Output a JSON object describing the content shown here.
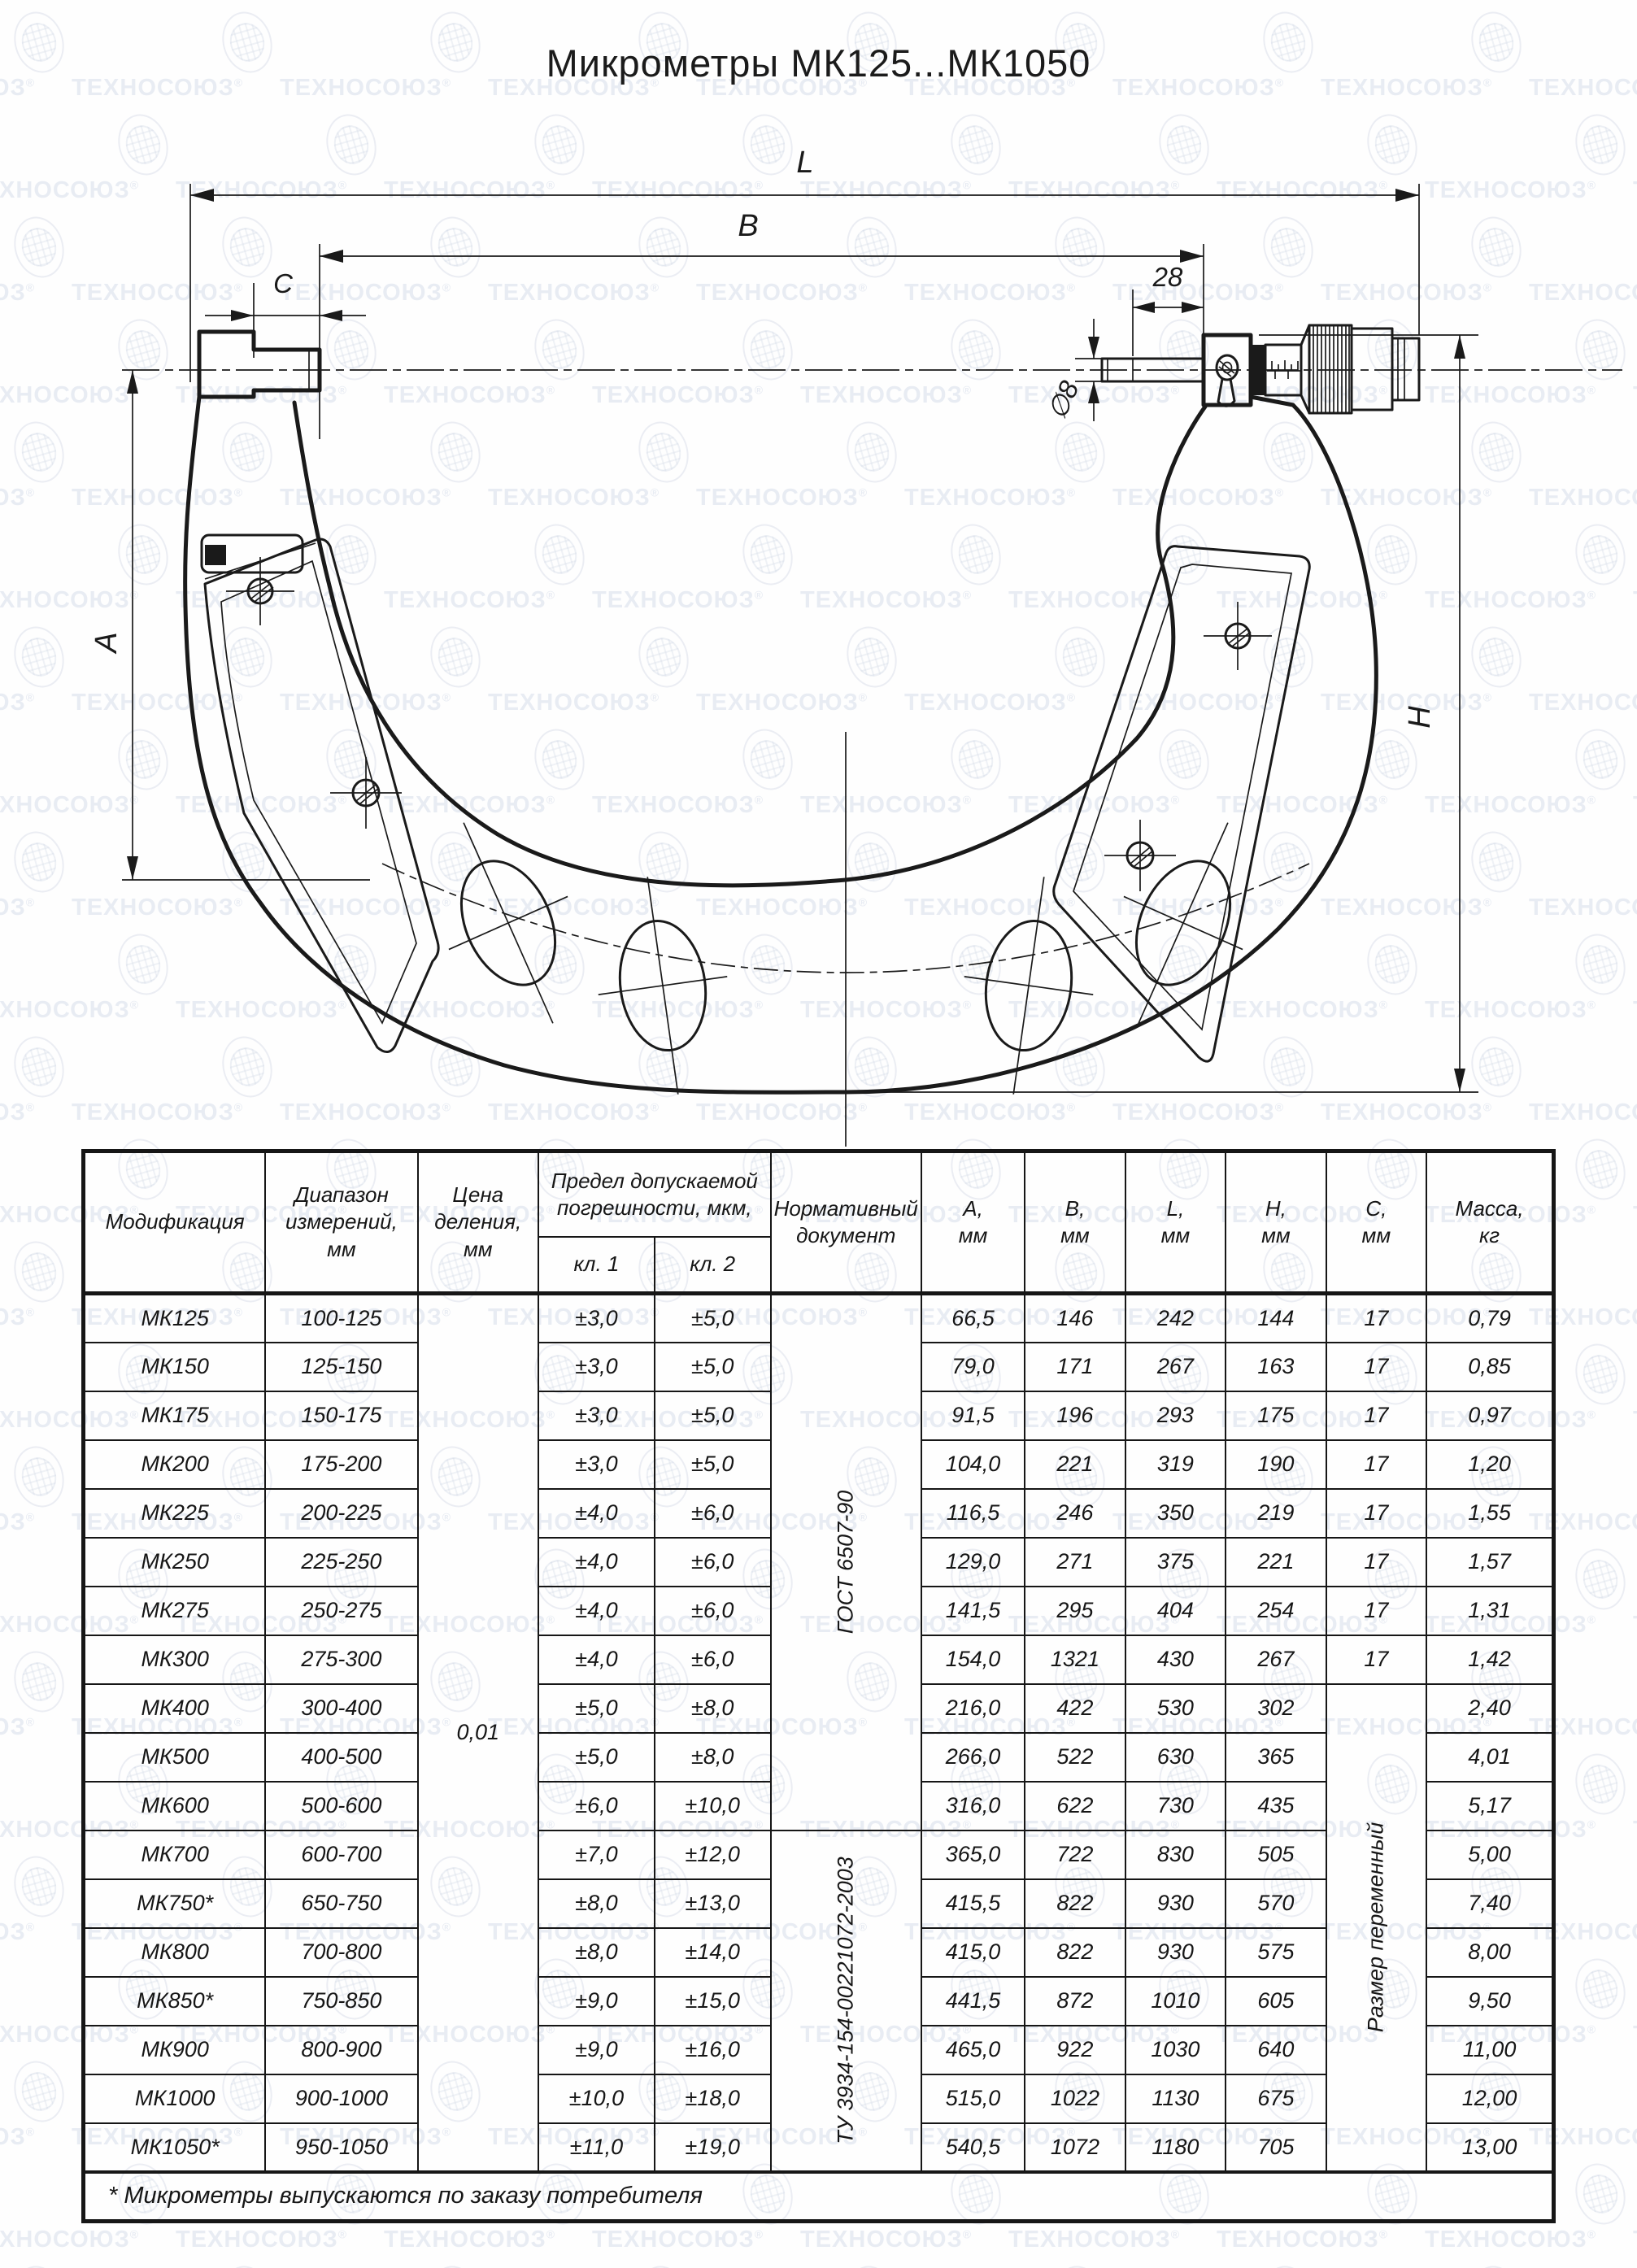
{
  "title": "Микрометры МК125...МК1050",
  "watermark": {
    "text": "ТЕХНОСОЮЗ",
    "reg": "®",
    "color": "#dbe1ec"
  },
  "drawing": {
    "dims": {
      "L": "L",
      "B": "B",
      "C": "C",
      "d28": "28",
      "dia8": "∅8",
      "A": "A",
      "H": "H"
    }
  },
  "table": {
    "headers": {
      "mod": [
        "Модификация"
      ],
      "range": [
        "Диапазон",
        "измерений,",
        "мм"
      ],
      "price": [
        "Цена",
        "деления,",
        "мм"
      ],
      "limit": [
        "Предел допускаемой",
        "погрешности, мкм,"
      ],
      "kl1": "кл. 1",
      "kl2": "кл. 2",
      "doc": [
        "Нормативный",
        "документ"
      ],
      "a": [
        "А,",
        "мм"
      ],
      "b": [
        "В,",
        "мм"
      ],
      "l": [
        "L,",
        "мм"
      ],
      "h": [
        "Н,",
        "мм"
      ],
      "c": [
        "С,",
        "мм"
      ],
      "mass": [
        "Масса,",
        "кг"
      ]
    },
    "merged": {
      "price": "0,01",
      "doc1": "ГОСТ 6507-90",
      "doc1_rows": 11,
      "doc2": "ТУ 3934-154-00221072-2003",
      "doc2_rows": 7,
      "c_var": "Размер переменный",
      "c_var_rows": 10
    },
    "rows": [
      {
        "mod": "МК125",
        "range": "100-125",
        "kl1": "±3,0",
        "kl2": "±5,0",
        "a": "66,5",
        "b": "146",
        "l": "242",
        "h": "144",
        "c": "17",
        "m": "0,79"
      },
      {
        "mod": "МК150",
        "range": "125-150",
        "kl1": "±3,0",
        "kl2": "±5,0",
        "a": "79,0",
        "b": "171",
        "l": "267",
        "h": "163",
        "c": "17",
        "m": "0,85"
      },
      {
        "mod": "МК175",
        "range": "150-175",
        "kl1": "±3,0",
        "kl2": "±5,0",
        "a": "91,5",
        "b": "196",
        "l": "293",
        "h": "175",
        "c": "17",
        "m": "0,97"
      },
      {
        "mod": "МК200",
        "range": "175-200",
        "kl1": "±3,0",
        "kl2": "±5,0",
        "a": "104,0",
        "b": "221",
        "l": "319",
        "h": "190",
        "c": "17",
        "m": "1,20"
      },
      {
        "mod": "МК225",
        "range": "200-225",
        "kl1": "±4,0",
        "kl2": "±6,0",
        "a": "116,5",
        "b": "246",
        "l": "350",
        "h": "219",
        "c": "17",
        "m": "1,55"
      },
      {
        "mod": "МК250",
        "range": "225-250",
        "kl1": "±4,0",
        "kl2": "±6,0",
        "a": "129,0",
        "b": "271",
        "l": "375",
        "h": "221",
        "c": "17",
        "m": "1,57"
      },
      {
        "mod": "МК275",
        "range": "250-275",
        "kl1": "±4,0",
        "kl2": "±6,0",
        "a": "141,5",
        "b": "295",
        "l": "404",
        "h": "254",
        "c": "17",
        "m": "1,31"
      },
      {
        "mod": "МК300",
        "range": "275-300",
        "kl1": "±4,0",
        "kl2": "±6,0",
        "a": "154,0",
        "b": "1321",
        "l": "430",
        "h": "267",
        "c": "17",
        "m": "1,42"
      },
      {
        "mod": "МК400",
        "range": "300-400",
        "kl1": "±5,0",
        "kl2": "±8,0",
        "a": "216,0",
        "b": "422",
        "l": "530",
        "h": "302",
        "m": "2,40"
      },
      {
        "mod": "МК500",
        "range": "400-500",
        "kl1": "±5,0",
        "kl2": "±8,0",
        "a": "266,0",
        "b": "522",
        "l": "630",
        "h": "365",
        "m": "4,01"
      },
      {
        "mod": "МК600",
        "range": "500-600",
        "kl1": "±6,0",
        "kl2": "±10,0",
        "a": "316,0",
        "b": "622",
        "l": "730",
        "h": "435",
        "m": "5,17"
      },
      {
        "mod": "МК700",
        "range": "600-700",
        "kl1": "±7,0",
        "kl2": "±12,0",
        "a": "365,0",
        "b": "722",
        "l": "830",
        "h": "505",
        "m": "5,00"
      },
      {
        "mod": "МК750*",
        "range": "650-750",
        "kl1": "±8,0",
        "kl2": "±13,0",
        "a": "415,5",
        "b": "822",
        "l": "930",
        "h": "570",
        "m": "7,40"
      },
      {
        "mod": "МК800",
        "range": "700-800",
        "kl1": "±8,0",
        "kl2": "±14,0",
        "a": "415,0",
        "b": "822",
        "l": "930",
        "h": "575",
        "m": "8,00"
      },
      {
        "mod": "МК850*",
        "range": "750-850",
        "kl1": "±9,0",
        "kl2": "±15,0",
        "a": "441,5",
        "b": "872",
        "l": "1010",
        "h": "605",
        "m": "9,50"
      },
      {
        "mod": "МК900",
        "range": "800-900",
        "kl1": "±9,0",
        "kl2": "±16,0",
        "a": "465,0",
        "b": "922",
        "l": "1030",
        "h": "640",
        "m": "11,00"
      },
      {
        "mod": "МК1000",
        "range": "900-1000",
        "kl1": "±10,0",
        "kl2": "±18,0",
        "a": "515,0",
        "b": "1022",
        "l": "1130",
        "h": "675",
        "m": "12,00"
      },
      {
        "mod": "МК1050*",
        "range": "950-1050",
        "kl1": "±11,0",
        "kl2": "±19,0",
        "a": "540,5",
        "b": "1072",
        "l": "1180",
        "h": "705",
        "m": "13,00"
      }
    ],
    "footnote": "* Микрометры выпускаются по заказу потребителя"
  }
}
